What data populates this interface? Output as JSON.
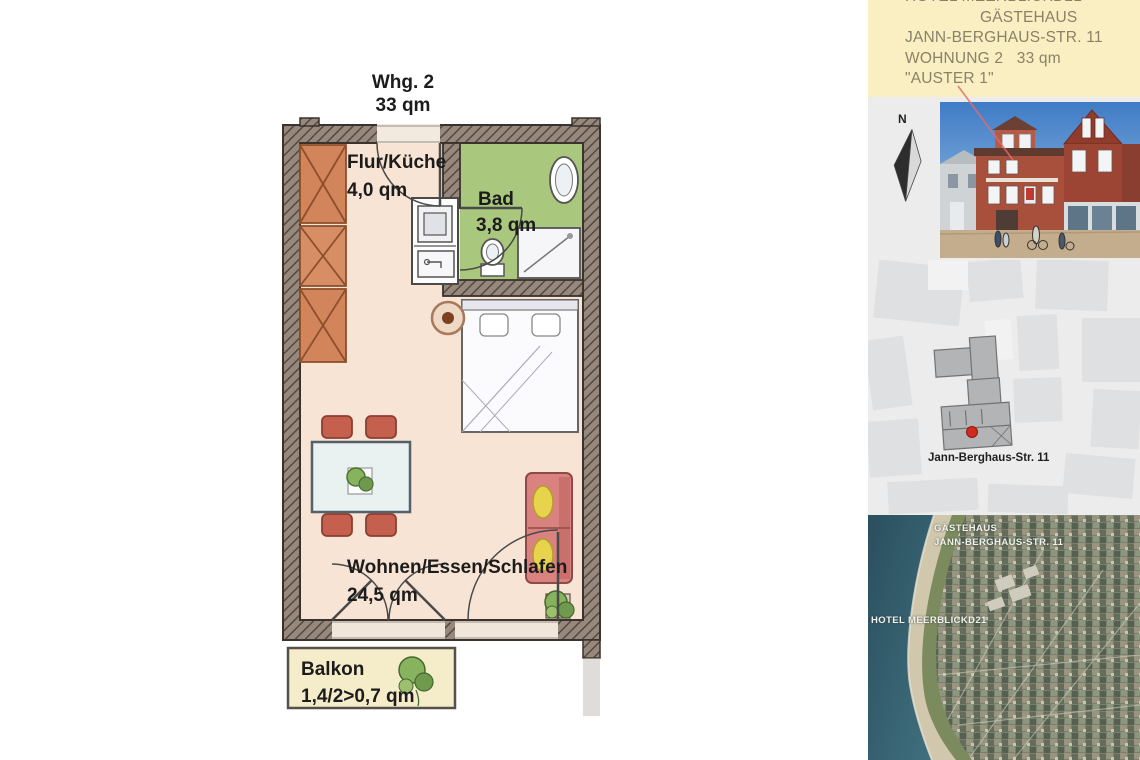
{
  "floor_plan": {
    "title": "Whg. 2",
    "subtitle": "33 qm",
    "rooms": [
      {
        "name": "Flur/Küche",
        "area": "4,0 qm"
      },
      {
        "name": "Bad",
        "area": "3,8 qm"
      },
      {
        "name": "Wohnen/Essen/Schlafen",
        "area": "24,5 qm"
      },
      {
        "name": "Balkon",
        "area": "1,4/2>0,7 qm"
      }
    ]
  },
  "sidebar": {
    "header": {
      "lines": [
        "HOTEL MEERBLICKD21",
        "GÄSTEHAUS",
        "JANN-BERGHAUS-STR. 11",
        "WOHNUNG 2   33 qm",
        "\"AUSTER 1\""
      ]
    },
    "compass": {
      "label": "N"
    },
    "site_map": {
      "caption": "Jann-Berghaus-Str. 11"
    },
    "aerial": {
      "label_top_line1": "GÄSTEHAUS",
      "label_top_line2": "JANN-BERGHAUS-STR. 11",
      "label_bottom": "HOTEL MEERBLICKD21"
    }
  },
  "colors": {
    "header_bg": "#f9efc3",
    "header_text": "#8a8166",
    "wall": "#96887d",
    "wall_hatch": "#54483f",
    "floor_peach": "#f7e4d4",
    "bad_green": "#a9c77d",
    "balkon_cream": "#f5ecca",
    "wardrobe_orange": "#d2845b",
    "sofa_red": "#d9827f",
    "cushion_yellow": "#e7d34c",
    "chair_red": "#c5604f",
    "table_top": "#eaf2f1",
    "sea": "#2a4f5e",
    "red_dot": "#cf2b20",
    "annotation_line": "#e86a6a"
  }
}
